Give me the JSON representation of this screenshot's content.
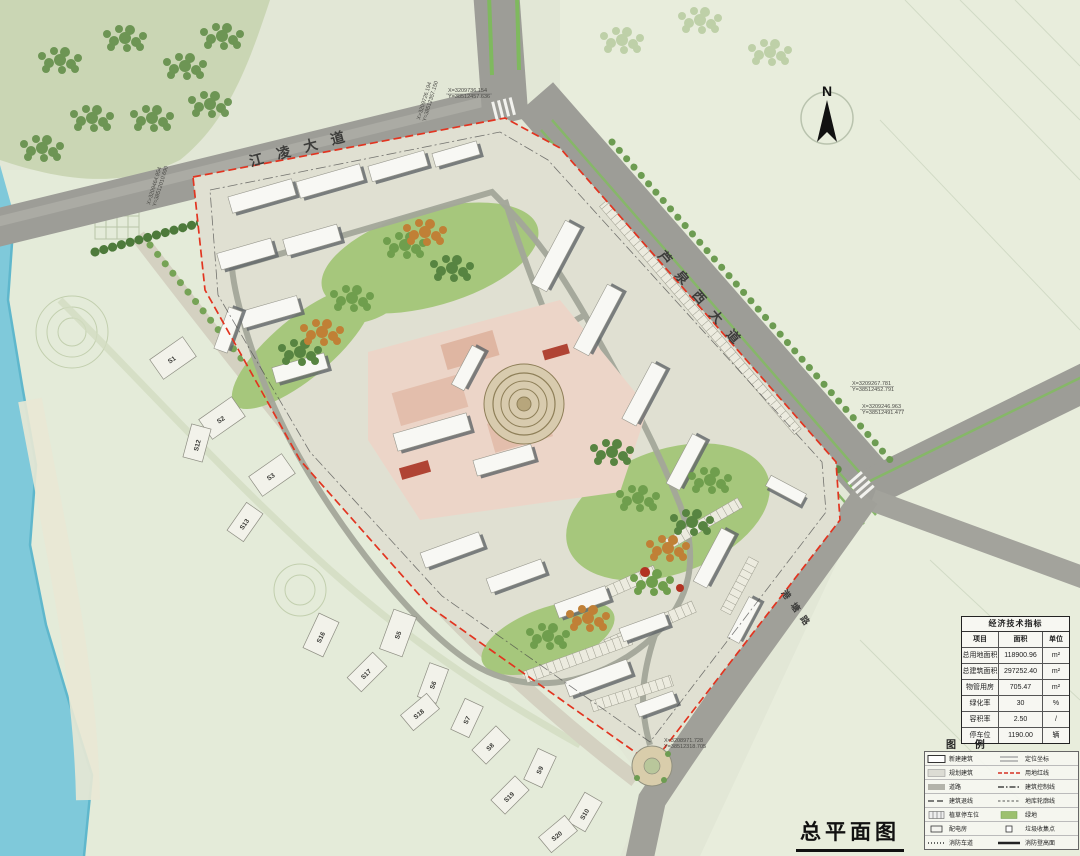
{
  "title": "总平面图",
  "compass": {
    "label": "N"
  },
  "roads": {
    "top": "江凌大道",
    "right": "芦泉西大道",
    "bottom": "港塘路"
  },
  "coords": [
    {
      "x": "X=3209464.954",
      "y": "Y=38512010.690"
    },
    {
      "x": "X=3209726.194",
      "y": "Y=38512357.150"
    },
    {
      "x": "X=3209736.154",
      "y": "Y=38512457.636"
    },
    {
      "x": "X=3209267.781",
      "y": "Y=38512452.791"
    },
    {
      "x": "X=3209246.963",
      "y": "Y=38512491.477"
    },
    {
      "x": "X=3208971.728",
      "y": "Y=38512318.705"
    }
  ],
  "villas": [
    "S1",
    "S2",
    "S12",
    "S3",
    "S13",
    "S16",
    "S5",
    "S17",
    "S6",
    "S18",
    "S7",
    "S8",
    "S9",
    "S19",
    "S10",
    "S20"
  ],
  "table": {
    "title": "经济技术指标",
    "headers": [
      "项目",
      "面积",
      "单位"
    ],
    "rows": [
      {
        "item": "总用地面积",
        "value": "118900.96",
        "unit": "m²"
      },
      {
        "item": "总建筑面积",
        "value": "297252.40",
        "unit": "m²"
      },
      {
        "item": "物管用房",
        "value": "705.47",
        "unit": "m²"
      },
      {
        "item": "绿化率",
        "value": "30",
        "unit": "%"
      },
      {
        "item": "容积率",
        "value": "2.50",
        "unit": "/"
      },
      {
        "item": "停车位",
        "value": "1190.00",
        "unit": "辆"
      }
    ]
  },
  "legend": {
    "title": "图 例",
    "left": [
      {
        "label": "新建建筑"
      },
      {
        "label": "规划建筑"
      },
      {
        "label": "道路"
      },
      {
        "label": "建筑退线"
      },
      {
        "label": "植草停车位"
      },
      {
        "label": "配电房"
      },
      {
        "label": "消防车道"
      }
    ],
    "right": [
      {
        "label": "定位坐标"
      },
      {
        "label": "用地红线"
      },
      {
        "label": "建筑控制线"
      },
      {
        "label": "地库轮廓线"
      },
      {
        "label": "绿地"
      },
      {
        "label": "垃圾收集点"
      },
      {
        "label": "消防登高面"
      }
    ]
  },
  "colors": {
    "river": "#7fc9da",
    "road": "#9d9d97",
    "boundary_red": "#e23420",
    "lawn": "#a6c77c",
    "commercial_pink": "#ecd5c8",
    "building": "#f8f8f4"
  }
}
